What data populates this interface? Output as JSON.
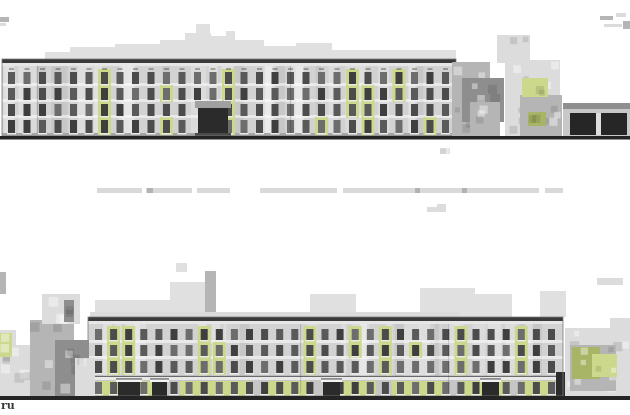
{
  "watermark": {
    "text": "ru"
  },
  "palette": {
    "background": "#ffffff",
    "skyline": "#e0e0e0",
    "facade": "#d2d2d2",
    "cornice": "#e6e6e6",
    "roof": "#3a3a3a",
    "ground": "#242424",
    "window": [
      "#3f3f3f",
      "#4c4c4c",
      "#5a5a5a",
      "#6d6d6d"
    ],
    "sill": "#ececec",
    "green": "#ccd88c",
    "green_dark": "#a9b566",
    "tree_light": "#dcdcdc",
    "tree_mid": "#b5b5b5",
    "tree_dark": "#8e8e8e",
    "entrance": "#2b2b2b",
    "canopy": "#a0a0a0",
    "caption": "#d9d9d9",
    "caption_tick": "#b2b2b2",
    "base_band": "#a6a6a6",
    "garage_body": "#c8c8c8",
    "garage_roof": "#8f8f8f"
  },
  "scene": {
    "width": 630,
    "height": 415,
    "top": {
      "skyline": [
        [
          45,
          52,
          70,
          8,
          "sky"
        ],
        [
          70,
          47,
          45,
          13,
          "sky"
        ],
        [
          115,
          44,
          50,
          16,
          "sky"
        ],
        [
          160,
          40,
          30,
          20,
          "sky"
        ],
        [
          185,
          33,
          26,
          27,
          "sky"
        ],
        [
          196,
          24,
          14,
          36,
          "sky"
        ],
        [
          210,
          36,
          20,
          24,
          "sky"
        ],
        [
          226,
          31,
          9,
          29,
          "sky"
        ],
        [
          234,
          40,
          30,
          20,
          "sky"
        ],
        [
          264,
          46,
          32,
          14,
          "sky"
        ],
        [
          296,
          43,
          36,
          17,
          "sky"
        ],
        [
          332,
          50,
          124,
          10,
          "sky"
        ],
        [
          0,
          17,
          9,
          5,
          "mid"
        ],
        [
          0,
          23,
          6,
          3,
          "light"
        ],
        [
          600,
          16,
          13,
          4,
          "mid"
        ],
        [
          616,
          13,
          10,
          4,
          "light"
        ],
        [
          604,
          24,
          18,
          3,
          "light"
        ],
        [
          623,
          21,
          7,
          8,
          "mid"
        ]
      ],
      "building": {
        "x": 2,
        "w": 454,
        "roof_y": 59,
        "base_y": 136,
        "col_start": 8,
        "cols": 29,
        "pitch": 15.5,
        "win_w": 7,
        "rows": [
          [
            72,
            12
          ],
          [
            88,
            12
          ],
          [
            104,
            12
          ],
          [
            120,
            13
          ]
        ],
        "greens": [
          [
            6,
            0,
            3
          ],
          [
            10,
            1,
            1
          ],
          [
            10,
            3,
            3
          ],
          [
            14,
            0,
            3
          ],
          [
            20,
            3,
            3
          ],
          [
            22,
            0,
            2
          ],
          [
            23,
            1,
            3
          ],
          [
            25,
            0,
            1
          ],
          [
            27,
            3,
            3
          ]
        ],
        "skips": [
          [
            12,
            2
          ],
          [
            12,
            3
          ],
          [
            13,
            2
          ],
          [
            13,
            3
          ]
        ],
        "downspouts": [
          37,
          290
        ],
        "entrance": {
          "x": 198,
          "w": 30,
          "canopy_y": 101,
          "body_y": 108
        }
      },
      "ground_y": 136,
      "ground_h": 3.5,
      "trees": [
        [
          452,
          62,
          38,
          75,
          "mid"
        ],
        [
          462,
          78,
          42,
          44,
          "dark"
        ],
        [
          470,
          102,
          30,
          34,
          "mid"
        ],
        [
          497,
          35,
          33,
          28,
          "light"
        ],
        [
          505,
          60,
          55,
          76,
          "light"
        ],
        [
          520,
          95,
          42,
          41,
          "mid"
        ],
        [
          522,
          78,
          26,
          19,
          "green"
        ],
        [
          528,
          112,
          18,
          14,
          "green_dark"
        ],
        [
          440,
          148,
          10,
          6,
          "light"
        ]
      ],
      "garage": {
        "x": 563,
        "y": 103,
        "w": 67,
        "h": 33,
        "doors": [
          [
            570,
            26
          ],
          [
            601,
            26
          ]
        ]
      }
    },
    "caption": {
      "y": 188,
      "h": 5,
      "segments": [
        [
          97,
          45
        ],
        [
          146,
          46
        ],
        [
          197,
          33
        ],
        [
          260,
          77
        ],
        [
          343,
          196
        ],
        [
          545,
          18
        ]
      ],
      "ticks": [
        [
          147,
          6
        ],
        [
          415,
          5
        ],
        [
          462,
          5
        ]
      ]
    },
    "bottom": {
      "skyline": [
        [
          95,
          300,
          80,
          17,
          "sky"
        ],
        [
          170,
          282,
          46,
          35,
          "sky"
        ],
        [
          205,
          271,
          11,
          46,
          "mid"
        ],
        [
          176,
          263,
          11,
          9,
          "sky"
        ],
        [
          310,
          294,
          46,
          23,
          "sky"
        ],
        [
          420,
          288,
          55,
          29,
          "sky"
        ],
        [
          427,
          207,
          10,
          5,
          "light"
        ],
        [
          437,
          204,
          9,
          8,
          "light"
        ],
        [
          470,
          294,
          42,
          23,
          "sky"
        ],
        [
          540,
          291,
          26,
          26,
          "sky"
        ],
        [
          597,
          278,
          26,
          7,
          "light"
        ],
        [
          0,
          272,
          6,
          22,
          "mid"
        ]
      ],
      "building": {
        "x": 88,
        "w": 475,
        "roof_y": 317,
        "base_y": 396,
        "col_start": 95,
        "cols": 31,
        "pitch": 15.1,
        "win_w": 7,
        "rows": [
          [
            329,
            11
          ],
          [
            345,
            11
          ],
          [
            361,
            12
          ],
          [
            382,
            12
          ]
        ],
        "greens": [
          [
            1,
            0,
            2
          ],
          [
            2,
            0,
            2
          ],
          [
            7,
            0,
            2
          ],
          [
            8,
            1,
            2
          ],
          [
            14,
            0,
            2
          ],
          [
            17,
            0,
            1
          ],
          [
            19,
            0,
            2
          ],
          [
            21,
            1,
            1
          ],
          [
            24,
            0,
            2
          ],
          [
            28,
            0,
            2
          ]
        ],
        "skips": [
          [
            2,
            3
          ],
          [
            4,
            3
          ],
          [
            15,
            3
          ],
          [
            26,
            3
          ]
        ],
        "downspouts": [
          300,
          448
        ],
        "parapet": [
          90,
          312,
          370,
          5
        ],
        "string_course_y": 377,
        "ground_band": [
          380,
          16
        ],
        "ground_greens": [
          [
            98,
            62
          ],
          [
            180,
            70
          ],
          [
            268,
            42
          ],
          [
            330,
            46
          ],
          [
            392,
            54
          ],
          [
            460,
            50
          ],
          [
            522,
            32
          ]
        ],
        "entrances": [
          [
            118,
            22
          ],
          [
            152,
            15
          ],
          [
            323,
            17
          ],
          [
            482,
            17
          ]
        ],
        "dark_block": [
          556,
          372,
          14,
          25
        ]
      },
      "ground_y": 396,
      "ground_h": 4,
      "trees_left": [
        [
          0,
          330,
          16,
          66,
          "light"
        ],
        [
          10,
          345,
          34,
          51,
          "light"
        ],
        [
          30,
          320,
          44,
          76,
          "mid"
        ],
        [
          42,
          294,
          38,
          30,
          "light"
        ],
        [
          55,
          340,
          34,
          56,
          "dark"
        ],
        [
          64,
          300,
          10,
          22,
          "dark"
        ],
        [
          75,
          358,
          20,
          38,
          "light"
        ],
        [
          0,
          333,
          12,
          24,
          "green"
        ]
      ],
      "trees_right": [
        [
          610,
          318,
          20,
          78,
          "light"
        ],
        [
          565,
          328,
          64,
          68,
          "light"
        ],
        [
          570,
          345,
          46,
          46,
          "mid"
        ],
        [
          572,
          347,
          28,
          32,
          "green_dark"
        ],
        [
          592,
          354,
          25,
          23,
          "green"
        ]
      ]
    }
  }
}
